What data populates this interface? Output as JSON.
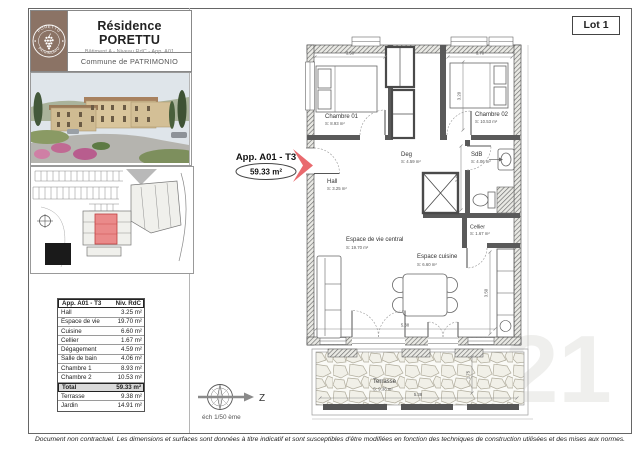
{
  "header": {
    "logo_top": "PORETTU",
    "logo_bottom": "PATRIMONIO",
    "title": "Résidence PORETTU",
    "subtitle": "Bâtiment A - Niveau RdC - App. A01",
    "commune": "Commune de PATRIMONIO"
  },
  "lot_label": "Lot 1",
  "apartment": {
    "name": "App. A01 - T3",
    "area": "59.33 m²"
  },
  "plan": {
    "rooms": [
      {
        "name": "Chambre 01",
        "area": "S: 8.93 m²"
      },
      {
        "name": "Chambre 02",
        "area": "S: 10.53 m²"
      },
      {
        "name": "Deg",
        "area": "S: 4.59 m²"
      },
      {
        "name": "SdB",
        "area": "S: 4.06 m²"
      },
      {
        "name": "Hall",
        "area": "S: 3.25 m²"
      },
      {
        "name": "Espace de vie central",
        "area": "S: 19.70 m²"
      },
      {
        "name": "Espace cuisine",
        "area": "S: 6.60 m²"
      },
      {
        "name": "Cellier",
        "area": "S: 1.67 m²"
      },
      {
        "name": "Terrasse",
        "area": "S: 9.38 m²"
      }
    ],
    "dims": {
      "ch1_w": "3.50",
      "ch2_w": "3.70",
      "ch2_h": "3.20",
      "sdb_h": "2.40",
      "kitchen_h": "3.50",
      "living_w": "5.38",
      "terrace_w": "5.38",
      "terrace_h": "1.75"
    },
    "scale": "éch 1/50 ème",
    "north": "Z"
  },
  "table": {
    "col_apartment": "App. A01 - T3",
    "col_level": "Niv. RdC",
    "rows": [
      {
        "label": "Hall",
        "value": "3.25 m²"
      },
      {
        "label": "Espace de vie",
        "value": "19.70 m²"
      },
      {
        "label": "Cuisine",
        "value": "6.60 m²"
      },
      {
        "label": "Cellier",
        "value": "1.67 m²"
      },
      {
        "label": "Dégagement",
        "value": "4.59 m²"
      },
      {
        "label": "Salle de bain",
        "value": "4.06 m²"
      },
      {
        "label": "Chambre 1",
        "value": "8.93 m²"
      },
      {
        "label": "Chambre 2",
        "value": "10.53 m²"
      },
      {
        "label": "Total",
        "value": "59.33 m²"
      },
      {
        "label": "Terrasse",
        "value": "9.38 m²"
      },
      {
        "label": "Jardin",
        "value": "14.91 m²"
      }
    ]
  },
  "footer": "Document non contractuel. Les dimensions et surfaces sont données à titre indicatif et sont susceptibles d'être modifiées en fonction des techniques de construction utilisées et des mises aux normes.",
  "watermark": "21",
  "colors": {
    "accent_red": "#e96a6e",
    "logo_brown": "#8b7365",
    "site_highlight": "#ea8a8a"
  }
}
